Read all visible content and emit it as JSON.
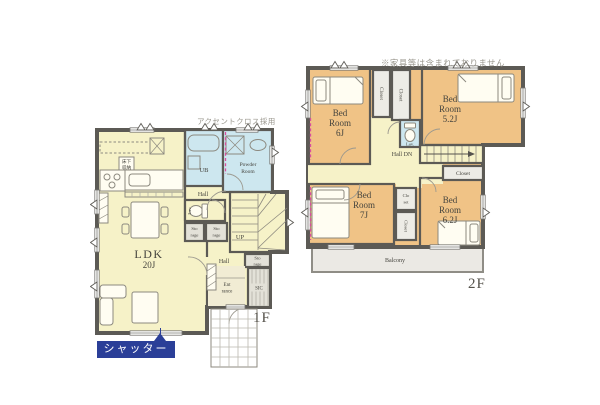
{
  "notes": {
    "furniture_disclaimer": "※家具等は含まれておりません",
    "accent_wallpaper": "アクセントクロス採用"
  },
  "colors": {
    "wall": "#5c5a55",
    "room_yellow": "#f6f2c8",
    "water_blue": "#cde7ef",
    "bedroom_orange": "#f0c386",
    "storage_gray": "#e3e1d8",
    "closet_white": "#edece6",
    "balcony_gray": "#ebe9e4",
    "entrance_tan": "#f1ecd4",
    "accent_pink": "#d94f9e",
    "shutter_navy": "#2b3f98"
  },
  "floor1": {
    "floor_label": "1F",
    "shutter": {
      "label": "シャッター"
    },
    "rooms": {
      "ldk": {
        "name": "LDK",
        "size": "20J"
      },
      "ub": {
        "name": "UB"
      },
      "powder": {
        "line1": "Powder",
        "line2": "Room"
      },
      "hall_upper": {
        "name": "Hall"
      },
      "hall_lower": {
        "name": "Hall"
      },
      "lav": {
        "name": "Lav"
      },
      "storage_a": {
        "line1": "Sto",
        "line2": "rage"
      },
      "storage_b": {
        "line1": "Sto",
        "line2": "rage"
      },
      "storage_c": {
        "line1": "Sto",
        "line2": "rage"
      },
      "stairs": {
        "label": "UP"
      },
      "entrance": {
        "line1": "Ent",
        "line2": "rance"
      },
      "sic": {
        "name": "SIC"
      },
      "floor_storage": {
        "line1": "床下",
        "line2": "収納"
      }
    }
  },
  "floor2": {
    "floor_label": "2F",
    "rooms": {
      "bed_6": {
        "line1": "Bed",
        "line2": "Room",
        "size": "6J"
      },
      "bed_52": {
        "line1": "Bed",
        "line2": "Room",
        "size": "5.2J"
      },
      "bed_7": {
        "line1": "Bed",
        "line2": "Room",
        "size": "7J"
      },
      "bed_62": {
        "line1": "Bed",
        "line2": "Room",
        "size": "6.2J"
      },
      "closet_a": {
        "name": "Closet"
      },
      "closet_b": {
        "name": "Closet"
      },
      "closet_right": {
        "name": "Closet"
      },
      "closet_mid": {
        "line1": "Clo",
        "line2": "set"
      },
      "closet_mid2": {
        "name": "Closet"
      },
      "lav": {
        "name": "Lav."
      },
      "hall": {
        "name": "Hall DN"
      },
      "balcony": {
        "name": "Balcony"
      }
    }
  }
}
